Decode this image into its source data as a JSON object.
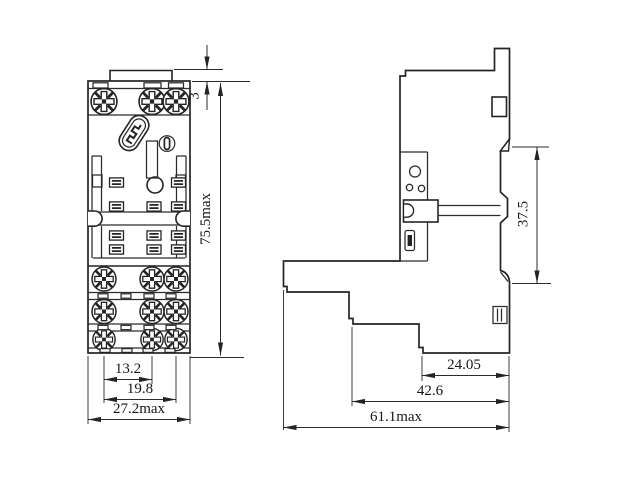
{
  "front_view": {
    "dims": {
      "tab_height": "3",
      "overall_height": "75.5max",
      "pitch_inner": "13.2",
      "pitch_outer": "19.8",
      "overall_width": "27.2max"
    }
  },
  "side_view": {
    "dims": {
      "din_rail_span": "37.5",
      "depth_step1": "24.05",
      "depth_step2": "42.6",
      "overall_depth": "61.1max"
    }
  },
  "colors": {
    "line": "#242424",
    "background": "#ffffff"
  }
}
